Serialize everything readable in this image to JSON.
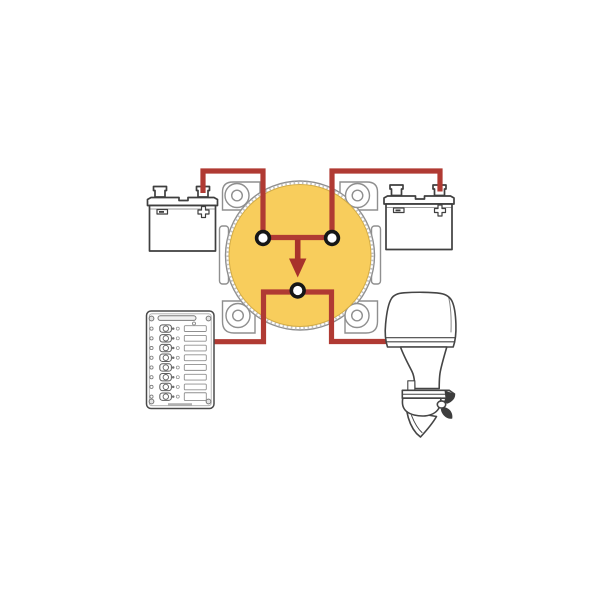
{
  "colors": {
    "background": "#ffffff",
    "wire": "#b03a33",
    "arrow": "#a8322b",
    "switch_knob": "#f8cd5c",
    "switch_knob_edge": "#d2ab45",
    "switch_plate_outline": "#8f8f8f",
    "terminal": "#161616",
    "terminal_center": "#ffffff",
    "battery_outline": "#3f3f3f",
    "panel_outline": "#4a4a4a",
    "motor_outline": "#454545"
  },
  "components": {
    "battery_left": {
      "label": "battery",
      "polarity_marks": [
        "-",
        "+"
      ]
    },
    "battery_right": {
      "label": "battery",
      "polarity_marks": [
        "-",
        "+"
      ]
    },
    "battery_switch": {
      "label": "dual-battery-switch",
      "terminal_count": 3
    },
    "breaker_panel": {
      "label": "circuit-breaker-panel",
      "row_count": 8
    },
    "outboard_motor": {
      "label": "outboard-motor"
    }
  },
  "wiring": {
    "connections": [
      "battery-left to switch-terminal-left",
      "battery-right to switch-terminal-right",
      "switch-terminal-bottom to breaker-panel",
      "switch-terminal-bottom to outboard-motor"
    ]
  }
}
